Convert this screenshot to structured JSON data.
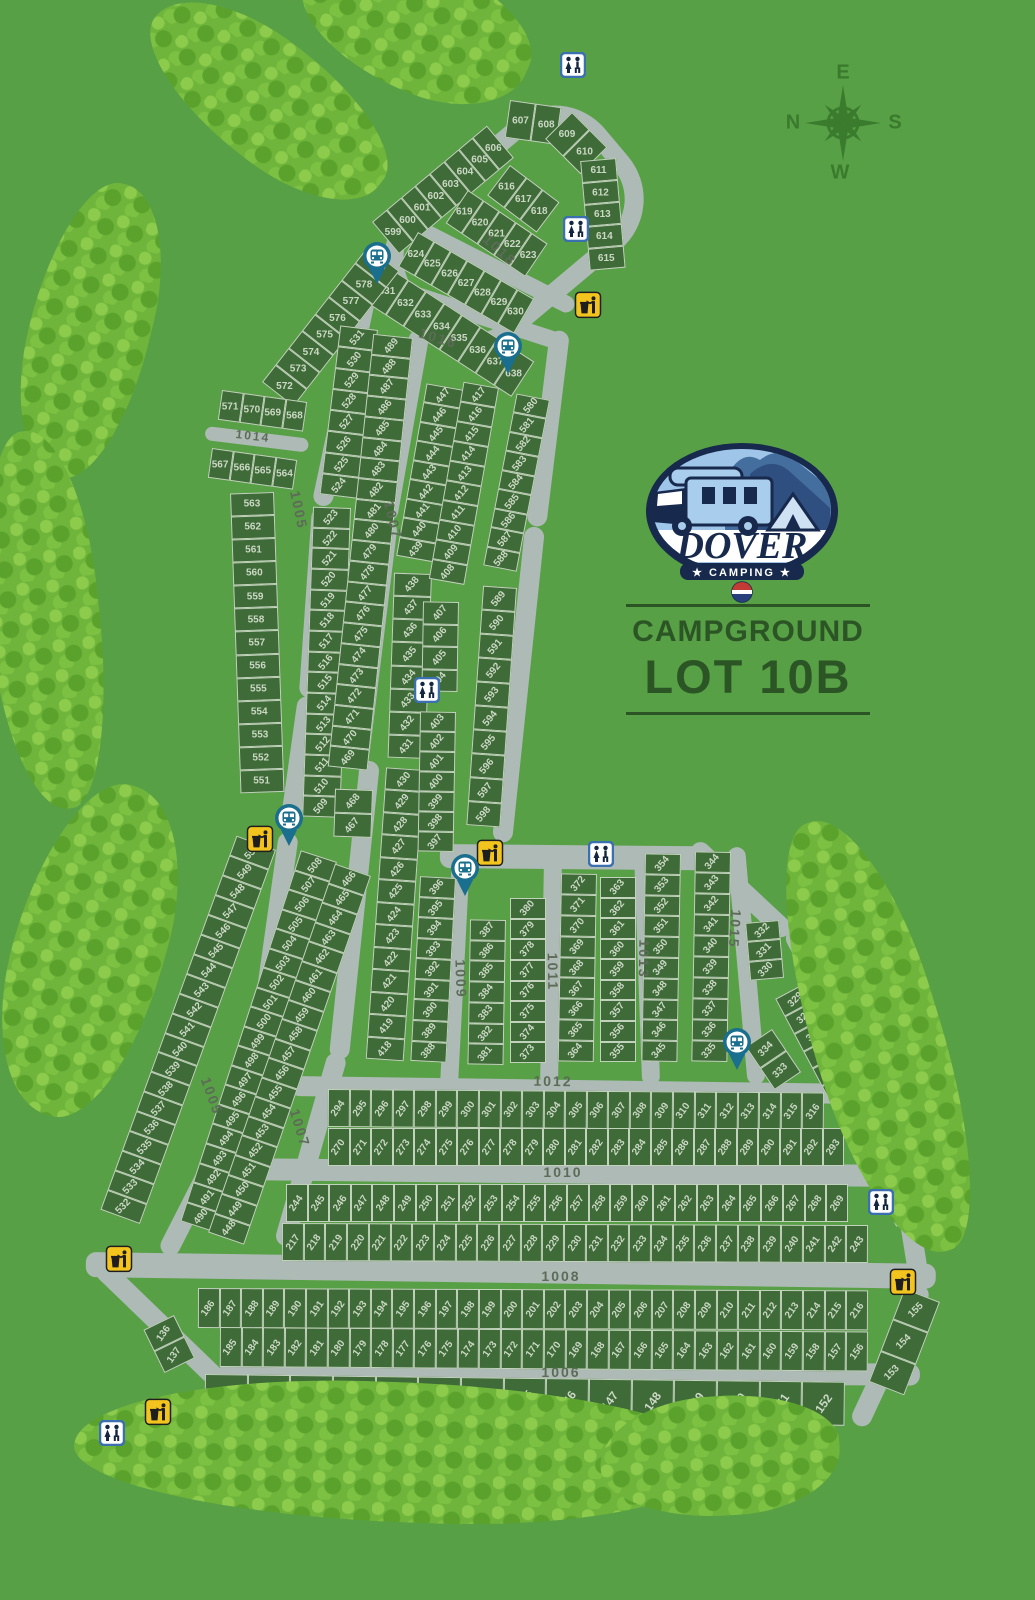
{
  "header": {
    "campground_label": "CAMPGROUND",
    "lot_label": "LOT 10B"
  },
  "logo": {
    "name": "DOVER",
    "tagline": "★ CAMPING ★"
  },
  "compass": {
    "top": "E",
    "right": "S",
    "bottom": "W",
    "left": "N"
  },
  "colors": {
    "background": "#58a046",
    "lot_fill": "#3e6b38",
    "road": "#adbab6",
    "lot_number": "#ccd8c5",
    "title_text": "#2c5526",
    "logo_navy": "#17294d",
    "restroom_blue": "#3a6fb0",
    "trash_yellow": "#f4c41e",
    "bus_teal": "#1a6e8e"
  },
  "icons": {
    "restroom": "restroom-icon",
    "trash": "trash-icon",
    "bus_stop": "bus-stop-icon"
  },
  "roads": {
    "1005": "1005",
    "1006": "1006",
    "1007": "1007",
    "1008": "1008",
    "1009": "1009",
    "1010": "1010",
    "1011": "1011",
    "1012": "1012",
    "1013": "1013",
    "1014": "1014",
    "1015": "1015",
    "1016": "1016",
    "1018": "1018"
  },
  "strips": {
    "s599": [
      "599",
      "600",
      "601",
      "602",
      "603",
      "604",
      "605",
      "606"
    ],
    "s607": [
      "607",
      "608"
    ],
    "s609": [
      "609",
      "610"
    ],
    "s611": [
      "611",
      "612",
      "613",
      "614",
      "615"
    ],
    "s616": [
      "616",
      "617",
      "618"
    ],
    "s619": [
      "619",
      "620",
      "621",
      "622",
      "623"
    ],
    "s624": [
      "624",
      "625",
      "626",
      "627",
      "628",
      "629",
      "630"
    ],
    "s631": [
      "631",
      "632",
      "633",
      "634",
      "635",
      "636",
      "637",
      "638"
    ],
    "s572": [
      "572",
      "573",
      "574",
      "575",
      "576",
      "577",
      "578",
      "579"
    ],
    "s571": [
      "571",
      "570",
      "569",
      "568"
    ],
    "s567": [
      "567",
      "566",
      "565",
      "564"
    ],
    "s563": [
      "563",
      "562",
      "561",
      "560",
      "559",
      "558",
      "557",
      "556",
      "555",
      "554",
      "553",
      "552",
      "551"
    ],
    "s550": [
      "550",
      "549",
      "548",
      "547",
      "546",
      "545",
      "544",
      "543",
      "542",
      "541",
      "540",
      "539",
      "538",
      "537",
      "536",
      "535",
      "534",
      "533",
      "532"
    ],
    "s136": [
      "136",
      "137"
    ],
    "s531": [
      "531",
      "530",
      "529",
      "528",
      "527",
      "526",
      "525",
      "524"
    ],
    "s523": [
      "523",
      "522",
      "521",
      "520",
      "519",
      "518",
      "517",
      "516",
      "515",
      "514",
      "513",
      "512",
      "511",
      "510",
      "509"
    ],
    "s508": [
      "508",
      "507",
      "506",
      "505",
      "504",
      "503",
      "502",
      "501",
      "500",
      "499",
      "498",
      "497",
      "496",
      "495",
      "494",
      "493",
      "492",
      "491",
      "490"
    ],
    "s489": [
      "489",
      "488",
      "487",
      "486",
      "485",
      "484",
      "483",
      "482",
      "481",
      "480",
      "479",
      "478",
      "477",
      "476",
      "475",
      "474",
      "473",
      "472",
      "471",
      "470",
      "469"
    ],
    "s468": [
      "468",
      "467"
    ],
    "s466": [
      "466",
      "465",
      "464",
      "463",
      "462",
      "461",
      "460",
      "459",
      "458",
      "457",
      "456",
      "455",
      "454",
      "453",
      "452",
      "451",
      "450",
      "449",
      "448"
    ],
    "s447": [
      "447",
      "446",
      "445",
      "444",
      "443",
      "442",
      "441",
      "440",
      "439"
    ],
    "s438": [
      "438",
      "437",
      "436",
      "435",
      "434",
      "433",
      "432",
      "431"
    ],
    "s430": [
      "430",
      "429",
      "428",
      "427",
      "426",
      "425",
      "424",
      "423",
      "422",
      "421",
      "420",
      "419",
      "418"
    ],
    "s417": [
      "417",
      "416",
      "415",
      "414",
      "413",
      "412",
      "411",
      "410",
      "409",
      "408"
    ],
    "s407": [
      "407",
      "406",
      "405",
      "404"
    ],
    "s403": [
      "403",
      "402",
      "401",
      "400",
      "399",
      "398",
      "397"
    ],
    "s396": [
      "396",
      "395",
      "394",
      "393",
      "392",
      "391",
      "390",
      "389",
      "388"
    ],
    "s580": [
      "580",
      "581",
      "582",
      "583",
      "584",
      "585",
      "586",
      "587",
      "588"
    ],
    "s589": [
      "589",
      "590",
      "591",
      "592",
      "593",
      "594",
      "595",
      "596",
      "597",
      "598"
    ],
    "s387": [
      "387",
      "386",
      "385",
      "384",
      "383",
      "382",
      "381"
    ],
    "s380": [
      "380",
      "379",
      "378",
      "377",
      "376",
      "375",
      "374",
      "373"
    ],
    "s372": [
      "372",
      "371",
      "370",
      "369",
      "368",
      "367",
      "366",
      "365",
      "364"
    ],
    "s363": [
      "363",
      "362",
      "361",
      "360",
      "359",
      "358",
      "357",
      "356",
      "355"
    ],
    "s354": [
      "354",
      "353",
      "352",
      "351",
      "350",
      "349",
      "348",
      "347",
      "346",
      "345"
    ],
    "s344": [
      "344",
      "343",
      "342",
      "341",
      "340",
      "339",
      "338",
      "337",
      "336",
      "335"
    ],
    "s332": [
      "332",
      "331",
      "330"
    ],
    "s329": [
      "329",
      "328",
      "327",
      "326",
      "325",
      "324",
      "323",
      "322",
      "321",
      "320",
      "319",
      "318",
      "317"
    ],
    "s334": [
      "334",
      "333"
    ],
    "s294": [
      "294",
      "295",
      "296",
      "297",
      "298",
      "299",
      "300",
      "301",
      "302",
      "303",
      "304",
      "305",
      "306",
      "307",
      "308",
      "309",
      "310",
      "311",
      "312",
      "313",
      "314",
      "315",
      "316"
    ],
    "s270": [
      "270",
      "271",
      "272",
      "273",
      "274",
      "275",
      "276",
      "277",
      "278",
      "279",
      "280",
      "281",
      "282",
      "283",
      "284",
      "285",
      "286",
      "287",
      "288",
      "289",
      "290",
      "291",
      "292",
      "293"
    ],
    "s244": [
      "244",
      "245",
      "246",
      "247",
      "248",
      "249",
      "250",
      "251",
      "252",
      "253",
      "254",
      "255",
      "256",
      "257",
      "258",
      "259",
      "260",
      "261",
      "262",
      "263",
      "264",
      "265",
      "266",
      "267",
      "268",
      "269"
    ],
    "s217": [
      "217",
      "218",
      "219",
      "220",
      "221",
      "222",
      "223",
      "224",
      "225",
      "226",
      "227",
      "228",
      "229",
      "230",
      "231",
      "232",
      "233",
      "234",
      "235",
      "236",
      "237",
      "238",
      "239",
      "240",
      "241",
      "242",
      "243"
    ],
    "s186": [
      "186",
      "187",
      "188",
      "189",
      "190",
      "191",
      "192",
      "193",
      "194",
      "195",
      "196",
      "197",
      "198",
      "199",
      "200",
      "201",
      "202",
      "203",
      "204",
      "205",
      "206",
      "207",
      "208",
      "209",
      "210",
      "211",
      "212",
      "213",
      "214",
      "215",
      "216"
    ],
    "s185": [
      "185",
      "184",
      "183",
      "182",
      "181",
      "180",
      "179",
      "178",
      "177",
      "176",
      "175",
      "174",
      "173",
      "172",
      "171",
      "170",
      "169",
      "168",
      "167",
      "166",
      "165",
      "164",
      "163",
      "162",
      "161",
      "160",
      "159",
      "158",
      "157",
      "156"
    ],
    "s138": [
      "138",
      "139",
      "140",
      "141",
      "142",
      "143",
      "144",
      "145",
      "146",
      "147",
      "148",
      "149",
      "150",
      "151",
      "152"
    ],
    "s153": [
      "155",
      "154",
      "153"
    ]
  }
}
